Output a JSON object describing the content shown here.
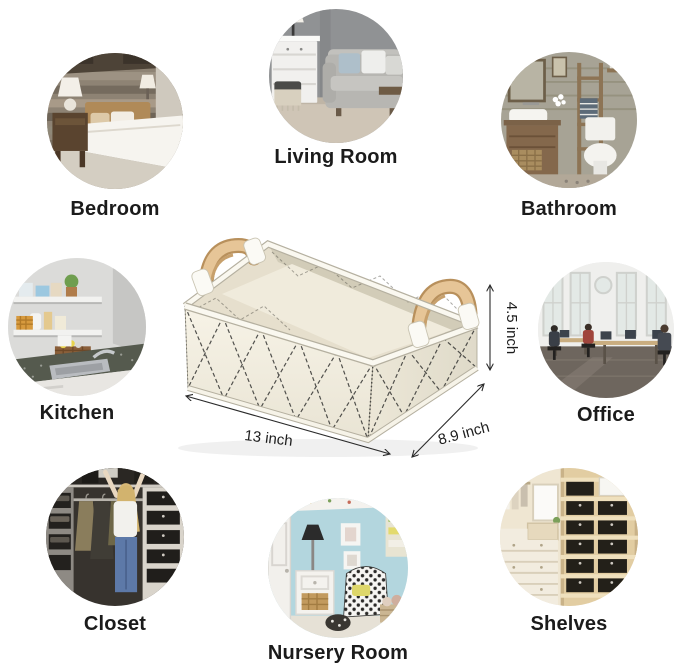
{
  "page": {
    "background": "#ffffff",
    "type": "product-usage-infographic"
  },
  "product": {
    "name": "fabric-storage-basket",
    "dimensions": {
      "width": "13 inch",
      "depth": "8.9 inch",
      "height": "4.5 inch"
    },
    "colors": {
      "fabric": "#f4f0e3",
      "fabric_shade": "#e9e4d4",
      "interior": "#e6dfcd",
      "stitch": "#3a3a38",
      "handle_wood": "#e6c597",
      "handle_wood_dark": "#c39a68",
      "trim": "#faf8f0",
      "dimension_text": "#1d1d1d"
    }
  },
  "rooms": [
    {
      "id": "bedroom",
      "label": "Bedroom"
    },
    {
      "id": "living-room",
      "label": "Living Room"
    },
    {
      "id": "bathroom",
      "label": "Bathroom"
    },
    {
      "id": "kitchen",
      "label": "Kitchen"
    },
    {
      "id": "office",
      "label": "Office"
    },
    {
      "id": "closet",
      "label": "Closet"
    },
    {
      "id": "nursery-room",
      "label": "Nursery Room"
    },
    {
      "id": "shelves",
      "label": "Shelves"
    }
  ]
}
